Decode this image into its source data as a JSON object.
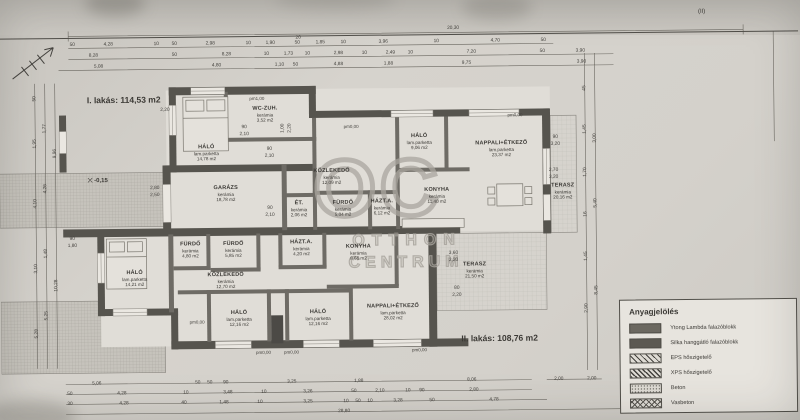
{
  "page": {
    "flat1_title": "I. lakás: 114,53 m2",
    "flat2_title": "II. lakás: 108,76 m2",
    "boundary_label": "(II)",
    "level_marker": "-0,15"
  },
  "watermark": {
    "monogram": "OC",
    "line1": "OTTHON",
    "line2": "CENTRUM"
  },
  "legend": {
    "title": "Anyagjelölés",
    "items": [
      {
        "label": "Ytong Lambda falazóblokk",
        "pattern": "solid"
      },
      {
        "label": "Silka hanggátló falazóblokk",
        "pattern": "solid2"
      },
      {
        "label": "EPS hőszigetelő",
        "pattern": "hatch"
      },
      {
        "label": "XPS hőszigetelő",
        "pattern": "hatch2"
      },
      {
        "label": "Beton",
        "pattern": "dots"
      },
      {
        "label": "Vasbeton",
        "pattern": "crosshatch"
      }
    ]
  },
  "rooms": [
    {
      "name": "HÁLÓ",
      "floor": "lam.parketta",
      "area": "14,78 m2",
      "x": 207,
      "y": 151
    },
    {
      "name": "WC-ZUH.",
      "floor": "kerámia",
      "area": "3,52 m2",
      "x": 266,
      "y": 113
    },
    {
      "name": "GARÁZS",
      "floor": "kerámia",
      "area": "18,78 m2",
      "x": 226,
      "y": 192
    },
    {
      "name": "KÖZLEKEDŐ",
      "floor": "kerámia",
      "area": "12,09 m2",
      "x": 332,
      "y": 176
    },
    {
      "name": "ÉT.",
      "floor": "kerámia",
      "area": "2,06 m2",
      "x": 299,
      "y": 208
    },
    {
      "name": "FÜRDŐ",
      "floor": "kerámia",
      "area": "5,04 m2",
      "x": 343,
      "y": 208
    },
    {
      "name": "HÁZT.A.",
      "floor": "kerámia",
      "area": "6,12 m2",
      "x": 382,
      "y": 207
    },
    {
      "name": "HÁLÓ",
      "floor": "lam.parketta",
      "area": "9,06 m2",
      "x": 420,
      "y": 142
    },
    {
      "name": "NAPPALI+ÉTKEZŐ",
      "floor": "lam.parketta",
      "area": "23,37 m2",
      "x": 502,
      "y": 150
    },
    {
      "name": "KONYHA",
      "floor": "kerámia",
      "area": "11,40 m2",
      "x": 437,
      "y": 196
    },
    {
      "name": "TERASZ",
      "floor": "kerámia",
      "area": "20,16 m2",
      "x": 563,
      "y": 193
    },
    {
      "name": "HÁLÓ",
      "floor": "lam.parketta",
      "area": "14,21 m2",
      "x": 134,
      "y": 276
    },
    {
      "name": "FÜRDŐ",
      "floor": "kerámia",
      "area": "4,80 m2",
      "x": 190,
      "y": 248
    },
    {
      "name": "FÜRDŐ",
      "floor": "kerámia",
      "area": "5,85 m2",
      "x": 233,
      "y": 248
    },
    {
      "name": "KÖZLEKEDŐ",
      "floor": "kerámia",
      "area": "12,70 m2",
      "x": 225,
      "y": 279
    },
    {
      "name": "HÁZT.A.",
      "floor": "kerámia",
      "area": "4,20 m2",
      "x": 301,
      "y": 247
    },
    {
      "name": "KONYHA",
      "floor": "kerámia",
      "area": "8,66 m2",
      "x": 358,
      "y": 252
    },
    {
      "name": "HÁLÓ",
      "floor": "lam.parketta",
      "area": "12,16 m2",
      "x": 238,
      "y": 317
    },
    {
      "name": "HÁLÓ",
      "floor": "lam.parketta",
      "area": "12,16 m2",
      "x": 317,
      "y": 317
    },
    {
      "name": "NAPPALI+ÉTKEZŐ",
      "floor": "lam.parketta",
      "area": "28,02 m2",
      "x": 392,
      "y": 312
    },
    {
      "name": "TERASZ",
      "floor": "kerámia",
      "area": "21,50 m2",
      "x": 474,
      "y": 271
    }
  ],
  "markers": [
    {
      "t": "pm1,00",
      "x": 258,
      "y": 97
    },
    {
      "t": "pm0,00",
      "x": 352,
      "y": 126
    },
    {
      "t": "pm0,00",
      "x": 516,
      "y": 116
    },
    {
      "t": "pm0,00",
      "x": 196,
      "y": 320
    },
    {
      "t": "pm0,00",
      "x": 262,
      "y": 351
    },
    {
      "t": "pm0,00",
      "x": 290,
      "y": 351
    },
    {
      "t": "pm0,00",
      "x": 418,
      "y": 350
    }
  ],
  "dims": [
    {
      "x": 455,
      "y": 29,
      "t": "20,30"
    },
    {
      "x": 300,
      "y": 37,
      "t": "20"
    },
    {
      "x": 74,
      "y": 42,
      "t": "50"
    },
    {
      "x": 110,
      "y": 42,
      "t": "4,28"
    },
    {
      "x": 158,
      "y": 42,
      "t": "10"
    },
    {
      "x": 176,
      "y": 42,
      "t": "50"
    },
    {
      "x": 212,
      "y": 42,
      "t": "2,98"
    },
    {
      "x": 250,
      "y": 42,
      "t": "10"
    },
    {
      "x": 272,
      "y": 42,
      "t": "1,90"
    },
    {
      "x": 299,
      "y": 42,
      "t": "50"
    },
    {
      "x": 322,
      "y": 42,
      "t": "1,85"
    },
    {
      "x": 345,
      "y": 42,
      "t": "10"
    },
    {
      "x": 385,
      "y": 42,
      "t": "3,96"
    },
    {
      "x": 438,
      "y": 42,
      "t": "10"
    },
    {
      "x": 497,
      "y": 42,
      "t": "4,70"
    },
    {
      "x": 545,
      "y": 42,
      "t": "50"
    },
    {
      "x": 95,
      "y": 53,
      "t": "8,28"
    },
    {
      "x": 176,
      "y": 53,
      "t": "50"
    },
    {
      "x": 228,
      "y": 53,
      "t": "8,28"
    },
    {
      "x": 268,
      "y": 53,
      "t": "10"
    },
    {
      "x": 290,
      "y": 53,
      "t": "1,73"
    },
    {
      "x": 309,
      "y": 53,
      "t": "10"
    },
    {
      "x": 340,
      "y": 53,
      "t": "2,98"
    },
    {
      "x": 366,
      "y": 53,
      "t": "10"
    },
    {
      "x": 392,
      "y": 53,
      "t": "2,49"
    },
    {
      "x": 412,
      "y": 53,
      "t": "10"
    },
    {
      "x": 473,
      "y": 53,
      "t": "7,20"
    },
    {
      "x": 544,
      "y": 53,
      "t": "50"
    },
    {
      "x": 582,
      "y": 53,
      "t": "3,90"
    },
    {
      "x": 100,
      "y": 64,
      "t": "5,08"
    },
    {
      "x": 218,
      "y": 64,
      "t": "4,80"
    },
    {
      "x": 281,
      "y": 64,
      "t": "1,10"
    },
    {
      "x": 297,
      "y": 64,
      "t": "50"
    },
    {
      "x": 340,
      "y": 64,
      "t": "4,88"
    },
    {
      "x": 390,
      "y": 64,
      "t": "1,88"
    },
    {
      "x": 468,
      "y": 64,
      "t": "9,75"
    },
    {
      "x": 583,
      "y": 64,
      "t": "3,90"
    },
    {
      "x": 95,
      "y": 381,
      "t": "5,06"
    },
    {
      "x": 196,
      "y": 381,
      "t": "50"
    },
    {
      "x": 208,
      "y": 381,
      "t": "50"
    },
    {
      "x": 224,
      "y": 381,
      "t": "90"
    },
    {
      "x": 290,
      "y": 381,
      "t": "3,25"
    },
    {
      "x": 357,
      "y": 381,
      "t": "1,88"
    },
    {
      "x": 470,
      "y": 381,
      "t": "8,06"
    },
    {
      "x": 557,
      "y": 381,
      "t": "2,00"
    },
    {
      "x": 590,
      "y": 381,
      "t": "2,00"
    },
    {
      "x": 68,
      "y": 391,
      "t": "50"
    },
    {
      "x": 120,
      "y": 391,
      "t": "4,28"
    },
    {
      "x": 184,
      "y": 391,
      "t": "10"
    },
    {
      "x": 226,
      "y": 391,
      "t": "3,48"
    },
    {
      "x": 262,
      "y": 391,
      "t": "10"
    },
    {
      "x": 306,
      "y": 391,
      "t": "3,26"
    },
    {
      "x": 352,
      "y": 391,
      "t": "50"
    },
    {
      "x": 378,
      "y": 391,
      "t": "2,10"
    },
    {
      "x": 406,
      "y": 391,
      "t": "10"
    },
    {
      "x": 420,
      "y": 391,
      "t": "90"
    },
    {
      "x": 472,
      "y": 391,
      "t": "2,80"
    },
    {
      "x": 68,
      "y": 401,
      "t": "30"
    },
    {
      "x": 122,
      "y": 401,
      "t": "4,28"
    },
    {
      "x": 182,
      "y": 401,
      "t": "40"
    },
    {
      "x": 222,
      "y": 401,
      "t": "1,48"
    },
    {
      "x": 258,
      "y": 401,
      "t": "10"
    },
    {
      "x": 306,
      "y": 401,
      "t": "3,25"
    },
    {
      "x": 344,
      "y": 401,
      "t": "10"
    },
    {
      "x": 356,
      "y": 401,
      "t": "50"
    },
    {
      "x": 368,
      "y": 401,
      "t": "10"
    },
    {
      "x": 396,
      "y": 401,
      "t": "3,28"
    },
    {
      "x": 430,
      "y": 401,
      "t": "50"
    },
    {
      "x": 492,
      "y": 401,
      "t": "4,78"
    },
    {
      "x": 342,
      "y": 411,
      "t": "28,80"
    },
    {
      "x": 36,
      "y": 95,
      "t": "50",
      "r": 1
    },
    {
      "x": 36,
      "y": 140,
      "t": "1,95",
      "r": 1
    },
    {
      "x": 36,
      "y": 200,
      "t": "4,10",
      "r": 1
    },
    {
      "x": 36,
      "y": 265,
      "t": "3,10",
      "r": 1
    },
    {
      "x": 36,
      "y": 330,
      "t": "5,28",
      "r": 1
    },
    {
      "x": 46,
      "y": 125,
      "t": "1,77",
      "r": 1
    },
    {
      "x": 46,
      "y": 185,
      "t": "4,26",
      "r": 1
    },
    {
      "x": 46,
      "y": 250,
      "t": "1,48",
      "r": 1
    },
    {
      "x": 46,
      "y": 312,
      "t": "5,25",
      "r": 1
    },
    {
      "x": 56,
      "y": 150,
      "t": "9,96",
      "r": 1
    },
    {
      "x": 56,
      "y": 282,
      "t": "10,28",
      "r": 1
    },
    {
      "x": 586,
      "y": 90,
      "t": "45",
      "r": 1
    },
    {
      "x": 586,
      "y": 131,
      "t": "1,45",
      "r": 1
    },
    {
      "x": 586,
      "y": 174,
      "t": "1,70",
      "r": 1
    },
    {
      "x": 586,
      "y": 216,
      "t": "16",
      "r": 1
    },
    {
      "x": 586,
      "y": 258,
      "t": "1,45",
      "r": 1
    },
    {
      "x": 586,
      "y": 310,
      "t": "2,90",
      "r": 1
    },
    {
      "x": 596,
      "y": 140,
      "t": "3,00",
      "r": 1
    },
    {
      "x": 596,
      "y": 205,
      "t": "5,40",
      "r": 1
    },
    {
      "x": 596,
      "y": 292,
      "t": "8,45",
      "r": 1
    },
    {
      "x": 155,
      "y": 186,
      "t": "2,80"
    },
    {
      "x": 155,
      "y": 193,
      "t": "2,50"
    },
    {
      "x": 166,
      "y": 108,
      "t": "2,20"
    },
    {
      "x": 245,
      "y": 126,
      "t": "90"
    },
    {
      "x": 245,
      "y": 133,
      "t": "2,10"
    },
    {
      "x": 270,
      "y": 148,
      "t": "90"
    },
    {
      "x": 270,
      "y": 155,
      "t": "2,10"
    },
    {
      "x": 270,
      "y": 207,
      "t": "90"
    },
    {
      "x": 270,
      "y": 214,
      "t": "2,10"
    },
    {
      "x": 284,
      "y": 127,
      "t": "1,00",
      "r": 1
    },
    {
      "x": 291,
      "y": 127,
      "t": "2,20",
      "r": 1
    },
    {
      "x": 556,
      "y": 139,
      "t": "90"
    },
    {
      "x": 556,
      "y": 146,
      "t": "3,20"
    },
    {
      "x": 554,
      "y": 172,
      "t": "2,70"
    },
    {
      "x": 554,
      "y": 179,
      "t": "3,20"
    },
    {
      "x": 453,
      "y": 254,
      "t": "3,60"
    },
    {
      "x": 453,
      "y": 261,
      "t": "2,20"
    },
    {
      "x": 456,
      "y": 289,
      "t": "80"
    },
    {
      "x": 456,
      "y": 296,
      "t": "2,20"
    },
    {
      "x": 72,
      "y": 236,
      "t": "90"
    },
    {
      "x": 72,
      "y": 243,
      "t": "1,80"
    }
  ]
}
